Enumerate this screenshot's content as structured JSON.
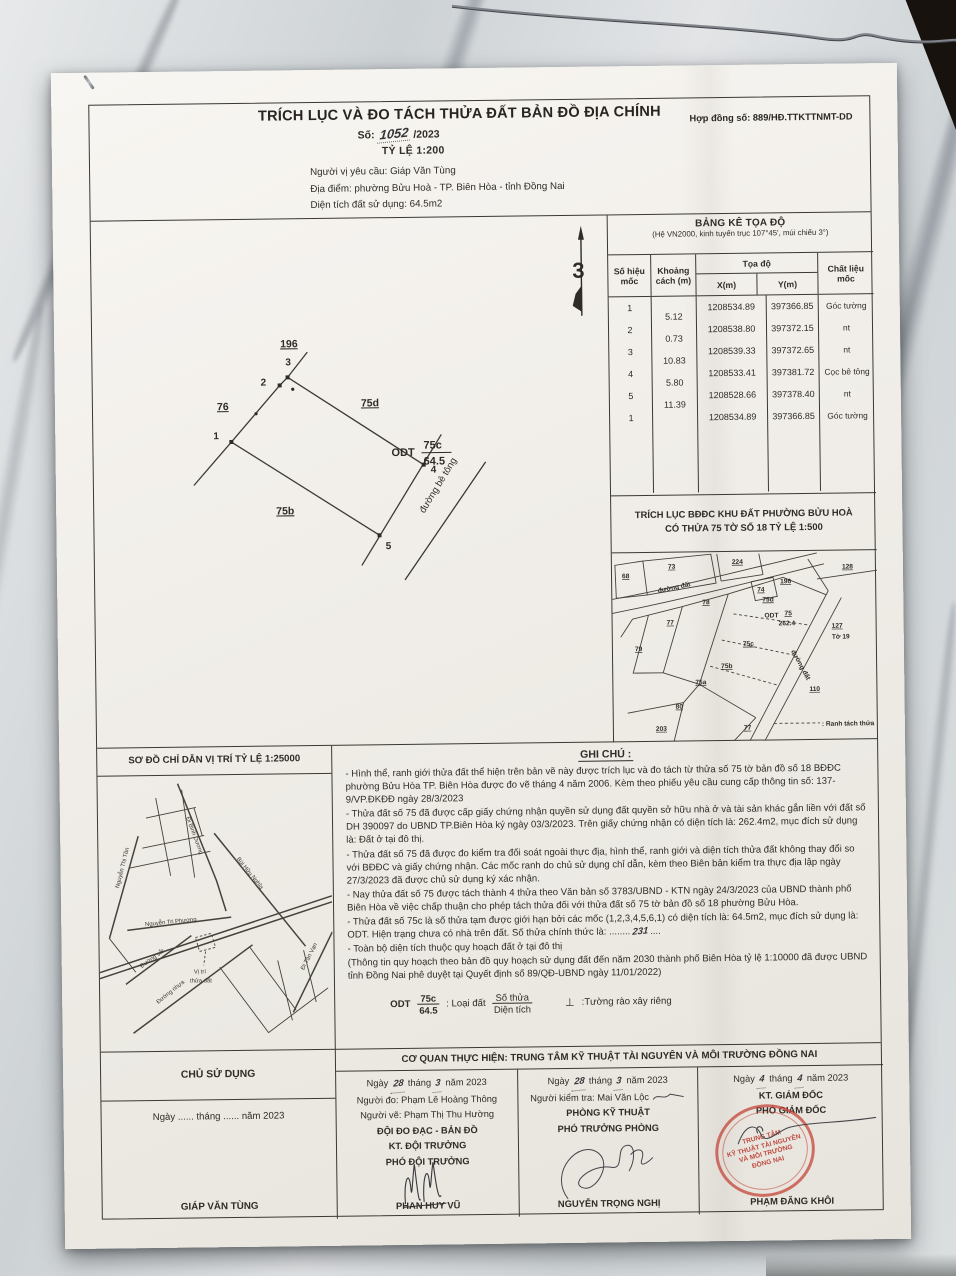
{
  "colors": {
    "ink": "#2f2c27",
    "stamp_red": "#c43e30",
    "paper": "#f1eee9"
  },
  "header": {
    "title": "TRÍCH LỤC VÀ ĐO TÁCH THỬA ĐẤT BẢN ĐỒ ĐỊA CHÍNH",
    "contract_no": "Hợp đồng số: 889/HĐ.TTKTTNMT-DD",
    "doc_no_label": "Số:",
    "doc_no_hand": "1052",
    "doc_no_year": "/2023",
    "scale": "TỶ LỆ  1:200",
    "requester": "Người vị yêu cầu: Giáp Văn Tùng",
    "location": "Địa điểm: phường Bửu Hoà - TP. Biên Hòa - tỉnh Đồng Nai",
    "area": "Diện tích đất sử dụng: 64.5m2"
  },
  "coord_table": {
    "title": "BẢNG KÊ TỌA ĐỘ",
    "subtitle": "(Hệ VN2000, kinh tuyến trục 107°45', múi chiếu 3°)",
    "col_marker": "Số hiệu mốc",
    "col_distance": "Khoảng cách (m)",
    "col_coords": "Tọa độ",
    "col_x": "X(m)",
    "col_y": "Y(m)",
    "col_material": "Chất liệu mốc",
    "rows": [
      {
        "id": "1",
        "x": "1208534.89",
        "y": "397366.85",
        "material": "Góc tường"
      },
      {
        "id": "2",
        "x": "1208538.80",
        "y": "397372.15",
        "material": "nt"
      },
      {
        "id": "3",
        "x": "1208539.33",
        "y": "397372.65",
        "material": "nt"
      },
      {
        "id": "4",
        "x": "1208533.41",
        "y": "397381.72",
        "material": "Cọc bê tông"
      },
      {
        "id": "5",
        "x": "1208528.66",
        "y": "397378.40",
        "material": "nt"
      },
      {
        "id": "1",
        "x": "1208534.89",
        "y": "397366.85",
        "material": "Góc tường"
      }
    ],
    "distances": [
      "5.12",
      "0.73",
      "10.83",
      "5.80",
      "11.39"
    ]
  },
  "main_sketch": {
    "north": "3",
    "points": [
      "1",
      "2",
      "3",
      "4",
      "5"
    ],
    "neighbor_top": "196",
    "neighbor_left": "76",
    "neighbor_right": "75d",
    "neighbor_bottom": "75b",
    "type": "ODT",
    "parcel": "75c",
    "area": "64.5",
    "road": "đường bê tông"
  },
  "map_extract": {
    "title1": "TRÍCH LỤC BĐĐC KHU ĐẤT PHƯỜNG BỬU HOÀ",
    "title2": "CÓ THỬA 75 TỜ SỐ 18 TỶ LỆ 1:500",
    "road_top": "đường đất",
    "road_right": "đường đất",
    "legend": ": Ranh tách thửa",
    "labels": {
      "p68": "68",
      "p73": "73",
      "p224": "224",
      "p74": "74",
      "p196": "196",
      "p128": "128",
      "p127": "127",
      "to19": "Tờ 19",
      "p78": "78",
      "p77": "77",
      "p79": "79",
      "p75d": "75d",
      "odt": "ODT",
      "p75": "75",
      "a262": "262.4",
      "p75c": "75c",
      "p75b": "75b",
      "p75a": "75a",
      "p80": "80",
      "p203": "203",
      "p77b": "77",
      "p110": "110"
    }
  },
  "location_map": {
    "title": "SƠ ĐỒ CHỈ DẪN VỊ TRÍ TỶ LỆ 1:25000",
    "roads": {
      "binh_duong": "Đi Bình Dương",
      "bui_huu_nghia": "Bùi Hữu Nghĩa",
      "nguyen_thi_ton": "Nguyễn Thị Tồn",
      "nguyen_tri_phuong": "Nguyễn Tri Phương",
      "duong_sat": "Đường sắt",
      "duong_nhua": "Đường nhựa",
      "di_tan_van": "Đi Tân Vạn"
    },
    "marker1": "Vị trí",
    "marker2": "thửa đất"
  },
  "notes": {
    "title": "GHI CHÚ :",
    "items": [
      "- Hình thể, ranh giới thửa đất thể hiện trên bản vẽ này được trích lục và đo tách từ thửa số 75 tờ bản đồ số 18 BĐĐC phường Bửu Hòa TP. Biên Hòa được đo vẽ tháng 4 năm 2006. Kèm theo phiếu yêu cầu cung cấp thông tin số: 137-9/VP.ĐKĐĐ ngày 28/3/2023",
      "- Thửa đất số 75 đã được cấp giấy chứng nhận quyền sử dụng đất quyền sở hữu nhà ở và tài sản khác gắn liền với đất số DH 390097 do UBND TP.Biên Hòa ký ngày 03/3/2023. Trên giấy chứng nhận có diện tích là: 262.4m2, mục đích sử dụng là: Đất ở tại đô thị.",
      "- Thửa đất số 75 đã được đo kiểm tra đối soát ngoài thực địa, hình thể, ranh giới và diện tích thửa đất không thay đổi so với BĐĐC và giấy chứng nhận. Các mốc ranh do chủ sử dụng chỉ dẫn, kèm theo Biên bản kiểm tra thực địa lập ngày 27/3/2023 đã được chủ sử dụng ký xác nhận.",
      "- Nay thửa đất số 75 được tách thành 4 thửa theo Văn bản số 3783/UBND - KTN ngày 24/3/2023 của UBND thành phố Biên Hòa về việc chấp thuận cho phép tách thửa đối với thửa đất số 75 tờ bản đồ số 18 phường Bửu Hòa.",
      "- Thửa đất số 75c là số thửa tạm được giới hạn bởi các mốc (1,2,3,4,5,6,1) có diện tích là: 64.5m2, mục đích sử dụng là: ODT. Hiện trạng chưa có nhà trên đất. Số thửa chính thức là: ........",
      "- Toàn bộ diện tích thuộc quy hoạch đất ở tại đô thị",
      "(Thông tin quy hoạch theo bản đồ quy hoạch sử dụng đất đến năm 2030 thành phố Biên Hòa tỷ lệ 1:10000 đã được UBND tỉnh Đồng Nai phê duyệt tại Quyết định số 89/QĐ-UBND ngày 11/01/2022)"
    ],
    "hand_no": "231",
    "trailing_dots": "....",
    "legend": {
      "type": "ODT",
      "num": "75c",
      "den": "64.5",
      "label1": ": Loại đất",
      "frac_top": "Số thửa",
      "frac_bottom": "Diện tích",
      "sym": "⊥",
      "label2": ":Tường rào xây riêng"
    }
  },
  "footer": {
    "agency": "CƠ QUAN THỰC HIỆN: TRUNG TÂM KỸ THUẬT TÀI NGUYÊN VÀ MÔI TRƯỜNG ĐỒNG NAI",
    "owner": {
      "title": "CHỦ SỬ DỤNG",
      "date": "Ngày ...... tháng ...... năm 2023",
      "name": "GIÁP VĂN TÙNG"
    },
    "col1": {
      "d1": "Ngày",
      "day": "28",
      "d2": "tháng",
      "month": "3",
      "d3": "năm 2023",
      "l1": "Người đo: Phạm Lê Hoàng Thông",
      "l2": "Người vẽ: Phạm Thị Thu Hường",
      "l3": "ĐỘI ĐO ĐẠC - BẢN ĐỒ",
      "l4": "KT. ĐỘI TRƯỞNG",
      "l5": "PHÓ ĐỘI TRƯỞNG",
      "name": "PHAN HUY VŨ"
    },
    "col2": {
      "d1": "Ngày",
      "day": "28",
      "d2": "tháng",
      "month": "3",
      "d3": "năm 2023",
      "l1": "Người kiểm tra: Mai Văn Lộc",
      "l2": "PHÒNG KỸ THUẬT",
      "l3": "PHÓ TRƯỞNG PHÒNG",
      "name": "NGUYỄN TRỌNG NGHỊ"
    },
    "col3": {
      "d1": "Ngày",
      "day": "4",
      "d2": "tháng",
      "month": "4",
      "d3": "năm 2023",
      "l1": "KT. GIÁM ĐỐC",
      "l2": "PHÓ GIÁM ĐỐC",
      "name": "PHẠM ĐĂNG KHÔI",
      "stamp": [
        "TRUNG TÂM",
        "KỸ THUẬT TÀI NGUYÊN",
        "VÀ MÔI TRƯỜNG",
        "ĐỒNG NAI"
      ]
    }
  }
}
